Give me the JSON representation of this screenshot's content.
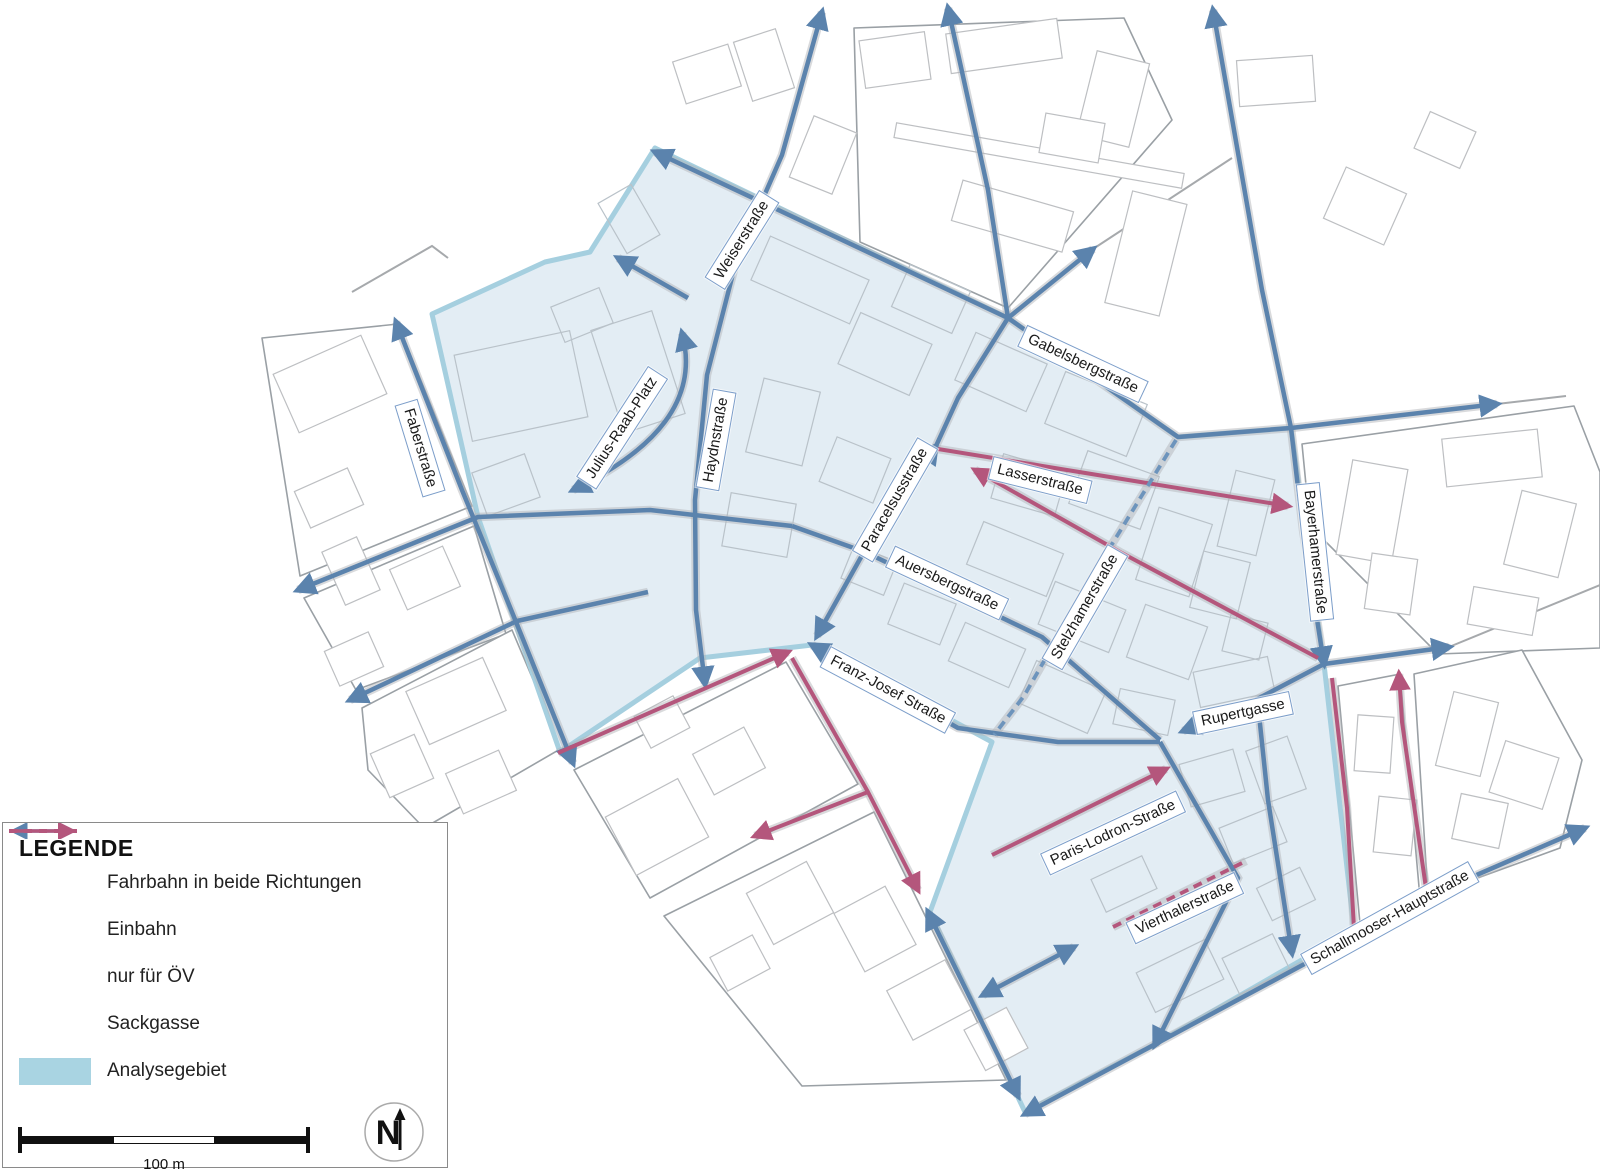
{
  "legend": {
    "title": "LEGENDE",
    "items": [
      {
        "id": "two-way",
        "label": "Fahrbahn in beide Richtungen"
      },
      {
        "id": "one-way",
        "label": "Einbahn"
      },
      {
        "id": "oev",
        "label": "nur für ÖV"
      },
      {
        "id": "dead-end",
        "label": "Sackgasse"
      },
      {
        "id": "area",
        "label": "Analysegebiet"
      }
    ],
    "scale_label": "100 m",
    "north_label": "N"
  },
  "streets": [
    "Weiserstraße",
    "Gabelsbergstraße",
    "Faberstraße",
    "Julius-Raab-Platz",
    "Haydnstraße",
    "Paracelsusstraße",
    "Lasserstraße",
    "Auersbergstraße",
    "Stelzhamerstraße",
    "Bayerhamerstraße",
    "Franz-Josef Straße",
    "Rupertgasse",
    "Paris-Lodron-Straße",
    "Vierthalerstraße",
    "Schallmooser-Hauptstraße"
  ],
  "colors": {
    "two_way": "#5b83ad",
    "one_way": "#b4567c",
    "oev": "#6d94bc",
    "dead_end": "#b4567c",
    "area_fill": "#e3edf4",
    "area_border": "#a5cfdf",
    "legend_area_swatch": "#a9d4e2"
  }
}
